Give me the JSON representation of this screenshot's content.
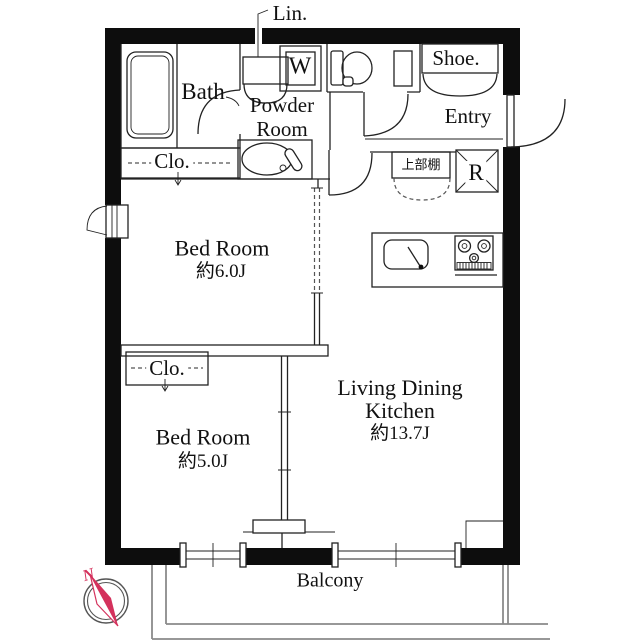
{
  "plan_title": "1LDK apartment floor plan",
  "colors": {
    "wall": "#0d0d0d",
    "interior_line": "#222222",
    "balcony_line": "#8a8a8a",
    "compass_accent": "#d4315c"
  },
  "rooms": {
    "bath": {
      "label": "Bath"
    },
    "powder_room": {
      "label": "Powder Room"
    },
    "linen": {
      "label": "Lin."
    },
    "washer": {
      "label": "W"
    },
    "shoe": {
      "label": "Shoe."
    },
    "entry": {
      "label": "Entry"
    },
    "upper_shelf": {
      "label": "上部棚"
    },
    "refrigerator": {
      "label": "R"
    },
    "closet_upper": {
      "label": "Clo."
    },
    "closet_lower": {
      "label": "Clo."
    },
    "bedroom_1": {
      "label": "Bed Room",
      "size": "約6.0J"
    },
    "bedroom_2": {
      "label": "Bed Room",
      "size": "約5.0J"
    },
    "ldk": {
      "label": "Living Dining Kitchen",
      "size": "約13.7J"
    }
  },
  "balcony": {
    "label": "Balcony"
  },
  "compass": {
    "north_label": "N"
  }
}
